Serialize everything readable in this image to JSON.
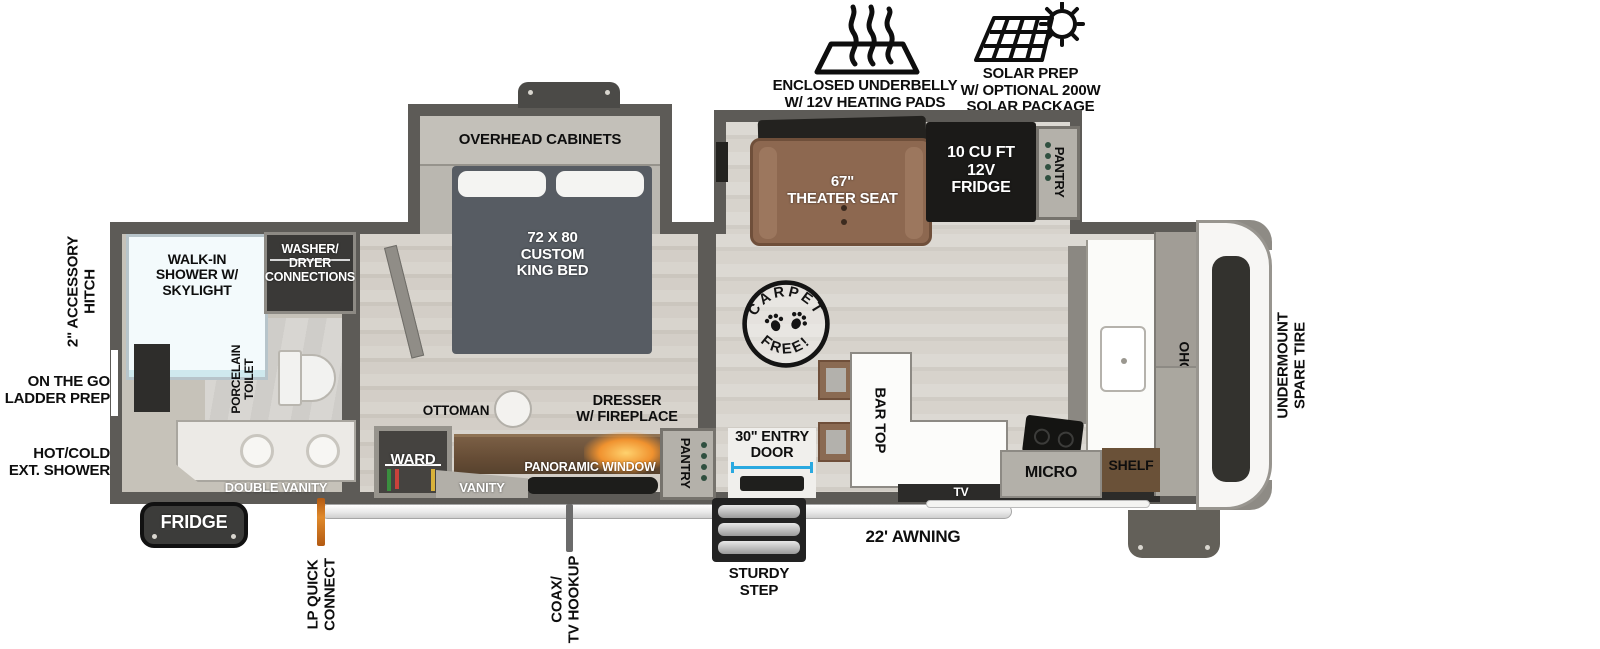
{
  "callouts": {
    "underbelly_line1": "ENCLOSED UNDERBELLY",
    "underbelly_line2": "W/ 12V HEATING PADS",
    "solar_line1": "SOLAR PREP",
    "solar_line2": "W/ OPTIONAL 200W",
    "solar_line3": "SOLAR PACKAGE"
  },
  "exterior": {
    "hitch_line1": "2\" ACCESSORY",
    "hitch_line2": "HITCH",
    "ladder_line1": "ON THE GO",
    "ladder_line2": "LADDER PREP",
    "ext_shower_line1": "HOT/COLD",
    "ext_shower_line2": "EXT. SHOWER",
    "spare_line1": "UNDERMOUNT",
    "spare_line2": "SPARE TIRE",
    "fridge": "FRIDGE",
    "lp_line1": "LP QUICK",
    "lp_line2": "CONNECT",
    "coax_line1": "COAX/",
    "coax_line2": "TV HOOKUP",
    "step_line1": "STURDY",
    "step_line2": "STEP",
    "awning": "22' AWNING"
  },
  "bathroom": {
    "shower_line1": "WALK-IN",
    "shower_line2": "SHOWER W/",
    "shower_line3": "SKYLIGHT",
    "washer_line1": "WASHER/",
    "washer_line2": "DRYER",
    "washer_line3": "CONNECTIONS",
    "toilet_line1": "PORCELAIN",
    "toilet_line2": "TOILET",
    "double_vanity": "DOUBLE VANITY"
  },
  "bedroom": {
    "overhead_cabinets": "OVERHEAD CABINETS",
    "bed_line1": "72 X 80",
    "bed_line2": "CUSTOM",
    "bed_line3": "KING BED",
    "ward": "WARD",
    "ottoman": "OTTOMAN",
    "dresser_line1": "DRESSER",
    "dresser_line2": "W/ FIREPLACE",
    "panoramic_window": "PANORAMIC WINDOW",
    "vanity": "VANITY"
  },
  "living": {
    "stamp_top": "CARPET",
    "stamp_bottom": "FREE!",
    "theater_line1": "67\"",
    "theater_line2": "THEATER SEAT",
    "fridge_line1": "10 CU FT",
    "fridge_line2": "12V",
    "fridge_line3": "FRIDGE",
    "pantry": "PANTRY",
    "bar_top": "BAR TOP",
    "entry_line1": "30\" ENTRY",
    "entry_line2": "DOOR",
    "entry_pantry": "PANTRY",
    "tv": "TV"
  },
  "kitchen": {
    "micro": "MICRO",
    "shelf": "SHELF",
    "ohc": "OHC"
  },
  "colors": {
    "wall": "#5d5b57",
    "accent_blue": "#2aa9e0",
    "flame_orange": "#f0922f",
    "seat_brown": "#8d6850",
    "wood_brown": "#6b523a",
    "dark_appliance": "#1b1a18"
  }
}
